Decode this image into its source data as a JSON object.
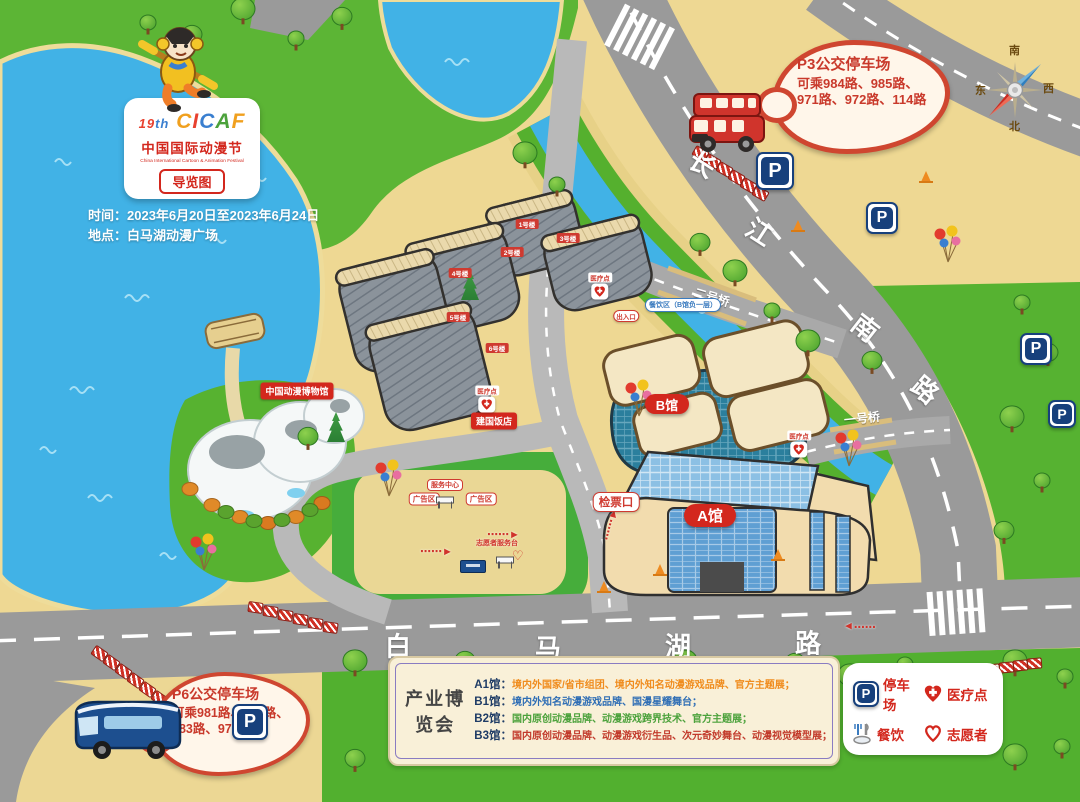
{
  "logo": {
    "edition_num": "19",
    "edition_suffix": "th",
    "brand_letters": [
      "C",
      "I",
      "C",
      "A",
      "F"
    ],
    "title_cn": "中国国际动漫节",
    "title_en": "China International Cartoon & Animation Festival",
    "map_badge": "导览图"
  },
  "info": {
    "time_label": "时间：",
    "time_value": "2023年6月20日至2023年6月24日",
    "place_label": "地点：",
    "place_value": "白马湖动漫广场"
  },
  "bus_parks": {
    "p3_title": "P3公交停车场",
    "p3_desc": "可乘984路、985路、971路、972路、114路",
    "p6_title": "P6公交停车场",
    "p6_desc": "可乘981路、982路、983路、973路"
  },
  "compass": {
    "n": "北",
    "s": "南",
    "e": "东",
    "w": "西"
  },
  "roads": {
    "changjiang_south_road": [
      "长",
      "江",
      "南",
      "路"
    ],
    "baimahu_road": [
      "白",
      "马",
      "湖",
      "路"
    ]
  },
  "bridges": {
    "no1": "一号桥",
    "no2": "二号桥"
  },
  "places": {
    "hall_a": "A馆",
    "hall_b": "B馆",
    "museum": "中国动漫博物馆",
    "hotel": "建国饭店",
    "ticket_gate": "检票口",
    "dining": "餐饮区（B馆负一层）",
    "gate": "出入口",
    "service_center": "服务中心",
    "ad_zone": "广告区",
    "volunteer_desk": "志愿者服务台",
    "medical": "医疗点",
    "p_letter": "P",
    "buildings": [
      "1号楼",
      "2号楼",
      "3号楼",
      "4号楼",
      "5号楼",
      "6号楼"
    ]
  },
  "expo": {
    "title": "产业博览会",
    "rows": [
      {
        "label": "A1馆：",
        "desc": "境内外国家/省市组团、境内外知名动漫游戏品牌、官方主题展；",
        "color": "#f08c1e"
      },
      {
        "label": "B1馆：",
        "desc": "境内外知名动漫游戏品牌、国漫星耀舞台；",
        "color": "#2f6eb5"
      },
      {
        "label": "B2馆：",
        "desc": "国内原创动漫品牌、动漫游戏跨界技术、官方主题展；",
        "color": "#4ca23c"
      },
      {
        "label": "B3馆：",
        "desc": "国内原创动漫品牌、动漫游戏衍生品、次元奇妙舞台、动漫视觉模型展；",
        "color": "#c23a2b"
      }
    ]
  },
  "legend": {
    "parking": "停车场",
    "medical": "医疗点",
    "dining": "餐饮",
    "volunteer": "志愿者"
  },
  "colors": {
    "water": "#41b2e6",
    "grass": "#5cb535",
    "sand": "#eed893",
    "road": "#9a9a9a",
    "accent_red": "#cf3a30",
    "badge_red": "#d3271d",
    "parking_blue": "#17407c"
  }
}
